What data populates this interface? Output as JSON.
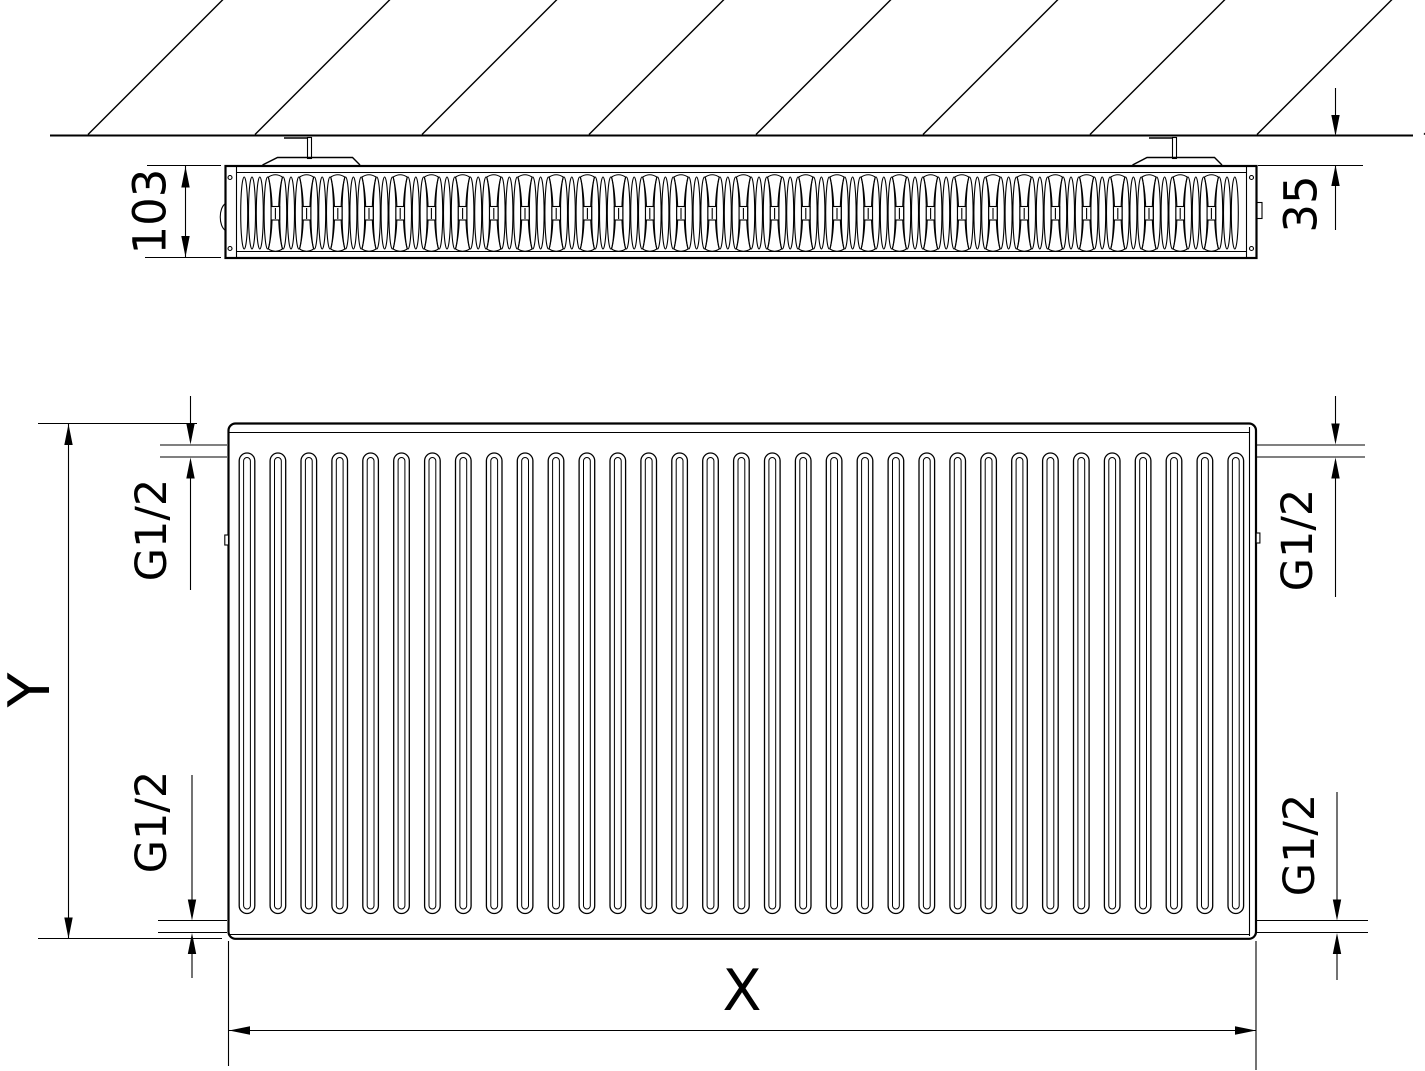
{
  "drawing": {
    "top_view": {
      "depth_dimension": "103",
      "wall_distance_dimension": "35"
    },
    "front_view": {
      "width_dimension": "X",
      "height_dimension": "Y",
      "connections": {
        "top_left": "G1/2",
        "bottom_left": "G1/2",
        "top_right": "G1/2",
        "bottom_right": "G1/2"
      }
    },
    "colors": {
      "line": "#000000",
      "background": "#ffffff"
    }
  }
}
